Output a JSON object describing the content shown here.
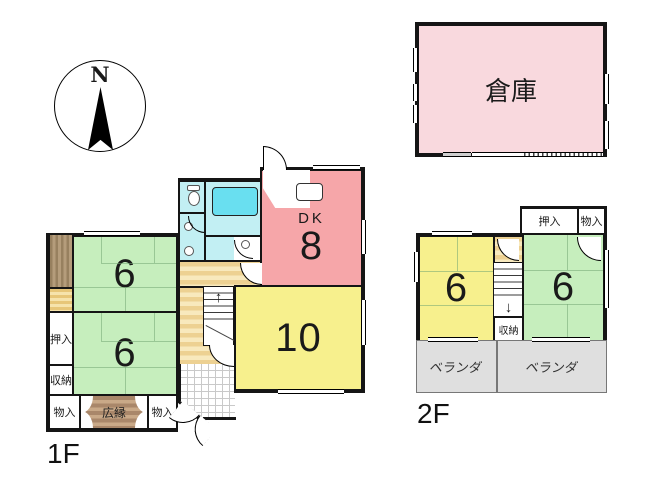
{
  "colors": {
    "wall": "#151515",
    "room_green": "#c6eebd",
    "tatami_line": "#74a874",
    "room_yellow": "#f7f08d",
    "dk_pink": "#f6a6a9",
    "warehouse_pink": "#f9d9de",
    "bath_cyan": "#c2eff3",
    "tub_cyan": "#69dff0",
    "hall_tan": "#edd192",
    "hall_tan_light": "#f8e9bd",
    "engawa_brown": "#97805f",
    "engawa_brown_light": "#b49c7b",
    "strip_yellow": "#e7c678",
    "strip_yellow_light": "#f6e3ab",
    "hiroen_brown": "#a9876a",
    "hiroen_brown_light": "#c9a988",
    "veranda_gray": "#dfdfdf"
  },
  "compass": {
    "north_label": "N"
  },
  "floor1": {
    "label": "1F",
    "dk_name": "DK",
    "dk_size": "8",
    "living_size": "10",
    "tatami_upper_size": "6",
    "tatami_lower_size": "6",
    "closet_oshiire": "押入",
    "closet_shunou": "収納",
    "closet_monoire_left": "物入",
    "closet_monoire_right": "物入",
    "hiroen_label": "広縁",
    "stairs_up_arrow": "↑"
  },
  "floor2": {
    "label": "2F",
    "room_left_size": "6",
    "room_right_size": "6",
    "closet_oshiire": "押入",
    "closet_monoire": "物入",
    "closet_shunou": "収納",
    "veranda_left_label": "ベランダ",
    "veranda_right_label": "ベランダ",
    "stairs_down_arrow": "↓"
  },
  "warehouse": {
    "label": "倉庫"
  }
}
